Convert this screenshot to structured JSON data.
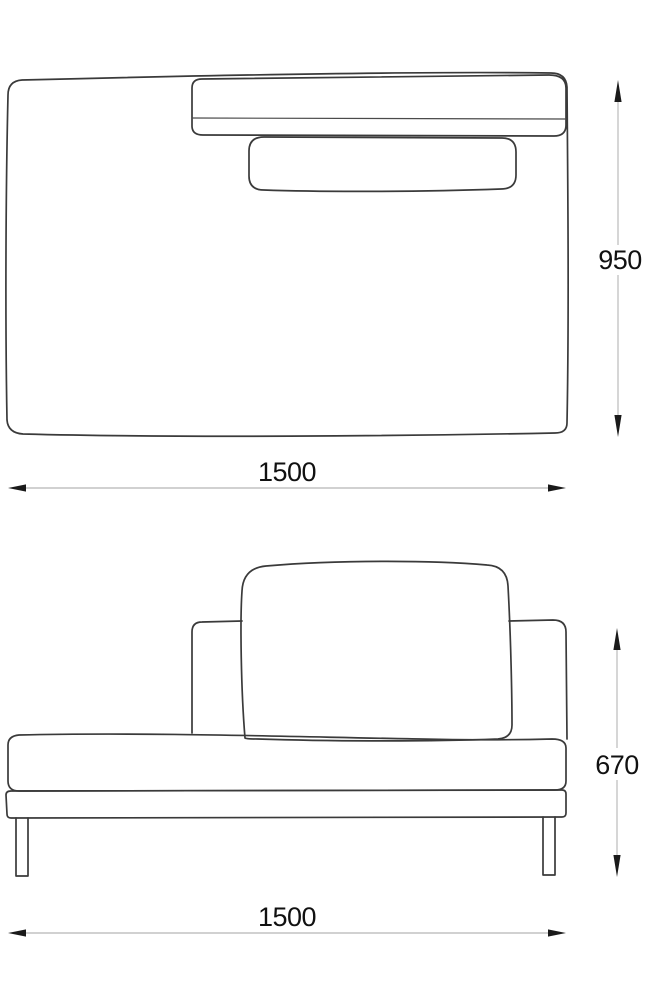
{
  "document": {
    "type": "furniture-technical-drawing",
    "background": "#ffffff",
    "outline_color": "#3a3a3a",
    "dimension_line_color": "#a3a3a3",
    "arrow_color": "#1a1a1a",
    "label_color": "#111111"
  },
  "views": {
    "top": {
      "name": "top-view",
      "width_label": "1500",
      "depth_label": "950"
    },
    "front": {
      "name": "front-view",
      "width_label": "1500",
      "height_label": "670"
    }
  }
}
